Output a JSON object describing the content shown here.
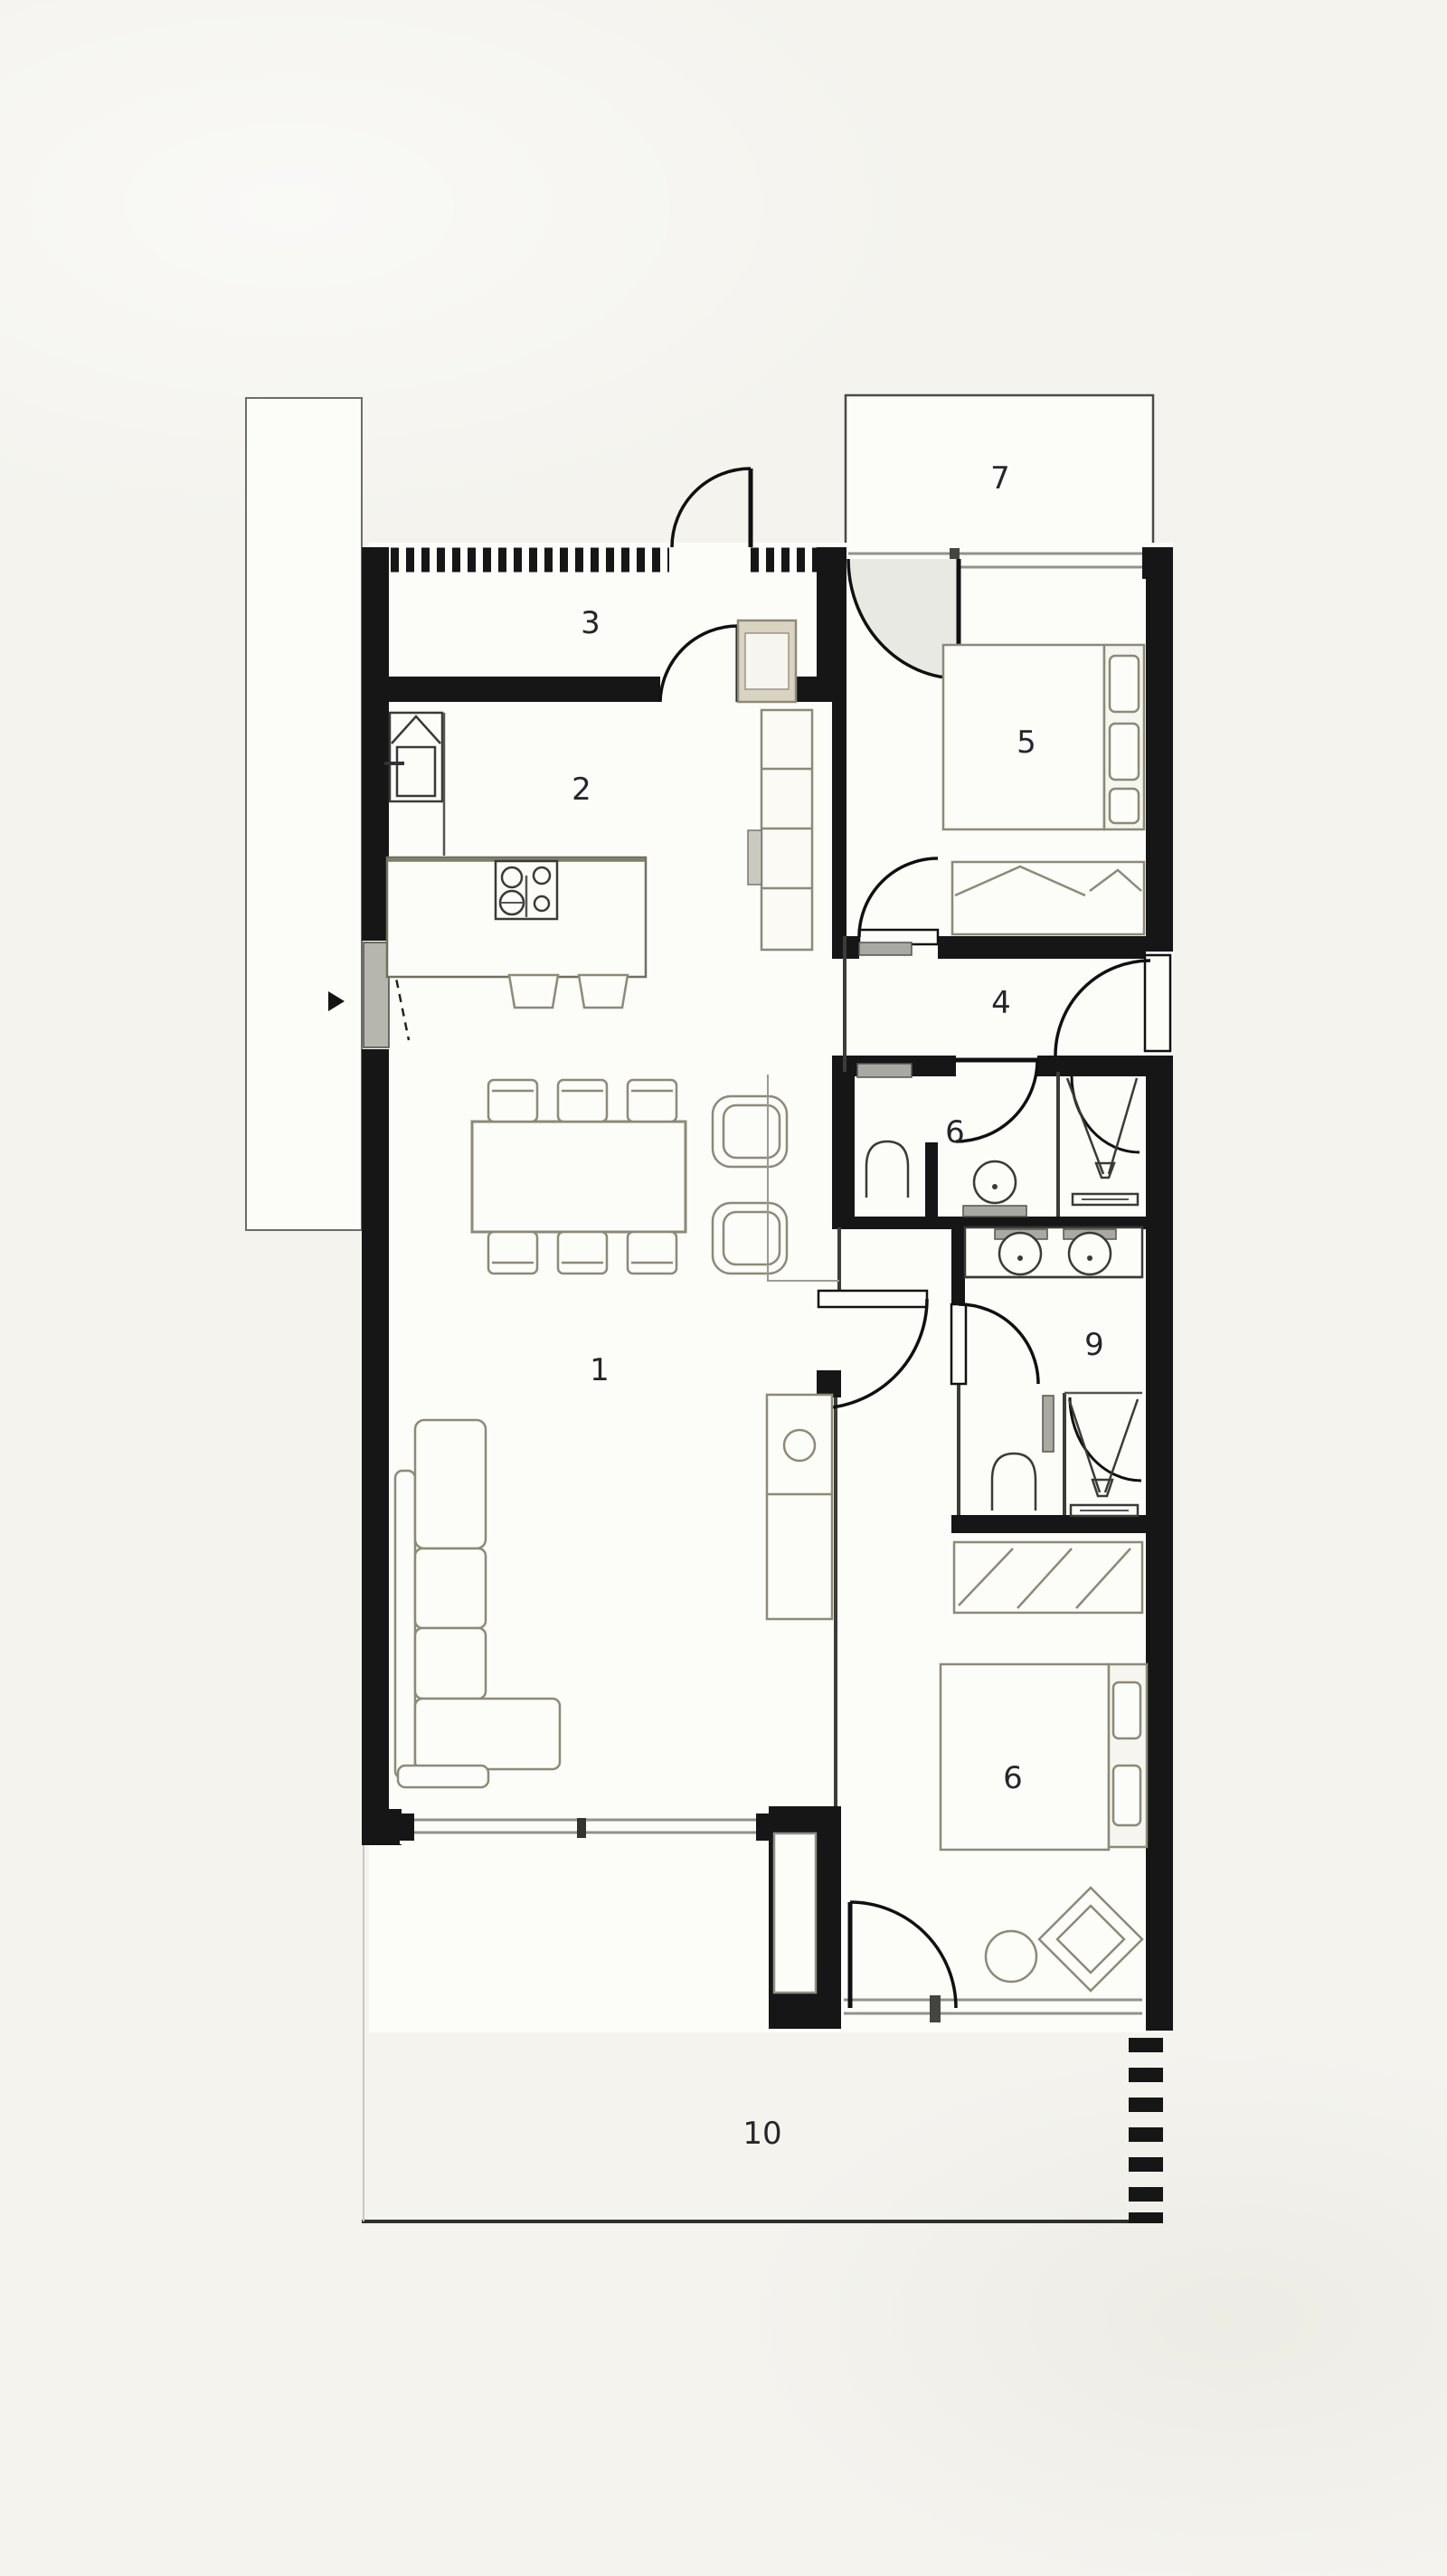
{
  "plan": {
    "type": "residential-floor-plan",
    "rooms": {
      "living": "1",
      "kitchen": "2",
      "entry_hall": "3",
      "hallway": "4",
      "bedroom_top": "5",
      "bathroom": "6",
      "balcony": "7",
      "bedroom_bottom": "6",
      "ensuite": "9",
      "terrace": "10"
    },
    "symbols": [
      "entry-arrow-icon",
      "door-swing-arc",
      "window-band",
      "hatched-wall",
      "kitchen-island-cooktop",
      "kitchen-sink",
      "dining-table-six-chairs",
      "armchair",
      "l-shaped-sofa",
      "double-bed",
      "wardrobe",
      "toilet",
      "shower",
      "double-washbasin",
      "round-side-table",
      "diamond-armchair",
      "dashed-terrace-wall"
    ]
  },
  "colors": {
    "paper": "#f4f3ee",
    "white": "#fcfcf9",
    "wall": "#161616",
    "furn": "#8b8b76",
    "win": "#92928a",
    "beige": "#d9d4c2",
    "gray": "#a9a9a1",
    "ink": "#26262a"
  }
}
